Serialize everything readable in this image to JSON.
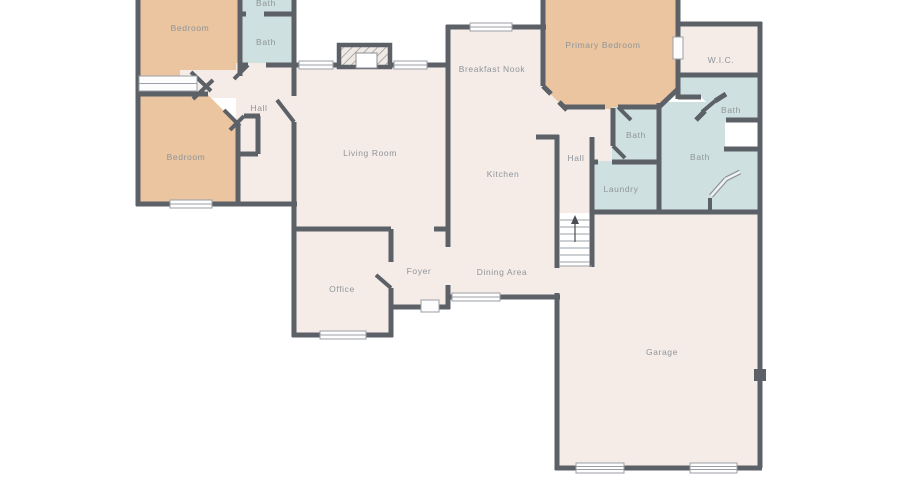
{
  "plan": {
    "title": "Floor plan",
    "palette": {
      "wall": "#5c6167",
      "room": "#f5ece8",
      "bedroom": "#eac5a0",
      "bath": "#cfe0e0",
      "label": "#8f9499",
      "window_line": "#9aa0a6"
    },
    "labels": {
      "bath_top": "Bath",
      "bath_upper": "Bath",
      "bedroom_top": "Bedroom",
      "hall_left": "Hall",
      "bedroom_bottom": "Bedroom",
      "living_room": "Living Room",
      "breakfast_nook": "Breakfast Nook",
      "kitchen": "Kitchen",
      "primary_bedroom": "Primary Bedroom",
      "wic": "W.I.C.",
      "bath_wic": "Bath",
      "bath_small": "Bath",
      "bath_primary": "Bath",
      "hall_center": "Hall",
      "laundry": "Laundry",
      "office": "Office",
      "foyer": "Foyer",
      "dining_area": "Dining Area",
      "garage": "Garage"
    }
  }
}
